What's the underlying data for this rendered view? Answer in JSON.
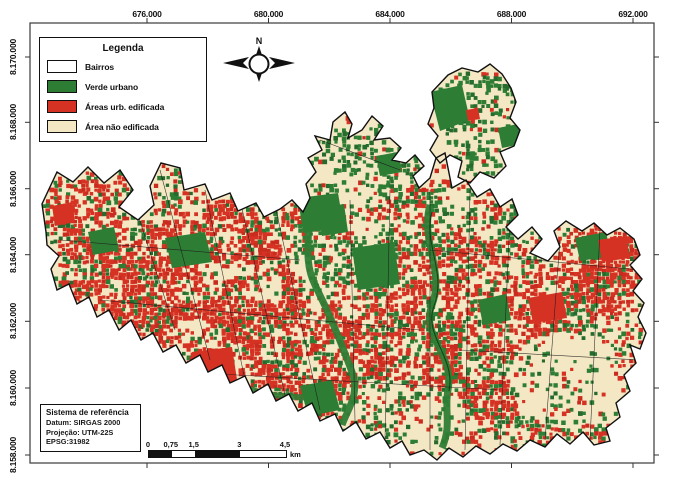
{
  "figure": {
    "type": "land-use-map",
    "background": "#ffffff",
    "frame_color": "#3a3a3a"
  },
  "axes": {
    "x_ticks": [
      "676.000",
      "680.000",
      "684.000",
      "688.000",
      "692.000"
    ],
    "y_ticks": [
      "8.170.000",
      "8.168.000",
      "8.166.000",
      "8.164.000",
      "8.162.000",
      "8.160.000",
      "8.158.000"
    ]
  },
  "legend": {
    "title": "Legenda",
    "items": [
      {
        "label": "Bairros",
        "color": "#ffffff",
        "border": "#111111"
      },
      {
        "label": "Verde urbano",
        "color": "#2E7D35",
        "border": "#111111"
      },
      {
        "label": "Áreas urb. edificada",
        "color": "#D63224",
        "border": "#111111"
      },
      {
        "label": "Área não edificada",
        "color": "#F4E7C3",
        "border": "#111111"
      }
    ]
  },
  "north_arrow": {
    "label": "N"
  },
  "reference_box": {
    "title": "Sistema de referência",
    "lines": [
      "Datum: SIRGAS 2000",
      "Projeção: UTM-22S",
      "EPSG:31982"
    ]
  },
  "scale_bar": {
    "labels": [
      "0",
      "0,75",
      "1,5",
      "3",
      "4,5"
    ],
    "unit": "km"
  },
  "map_classes": {
    "urban_green": "#2E7D35",
    "urban_green_dark": "#256B2D",
    "built_up": "#D63224",
    "built_up_dark": "#C92B1F",
    "non_built": "#F4E7C3",
    "boundary": "#111111"
  }
}
